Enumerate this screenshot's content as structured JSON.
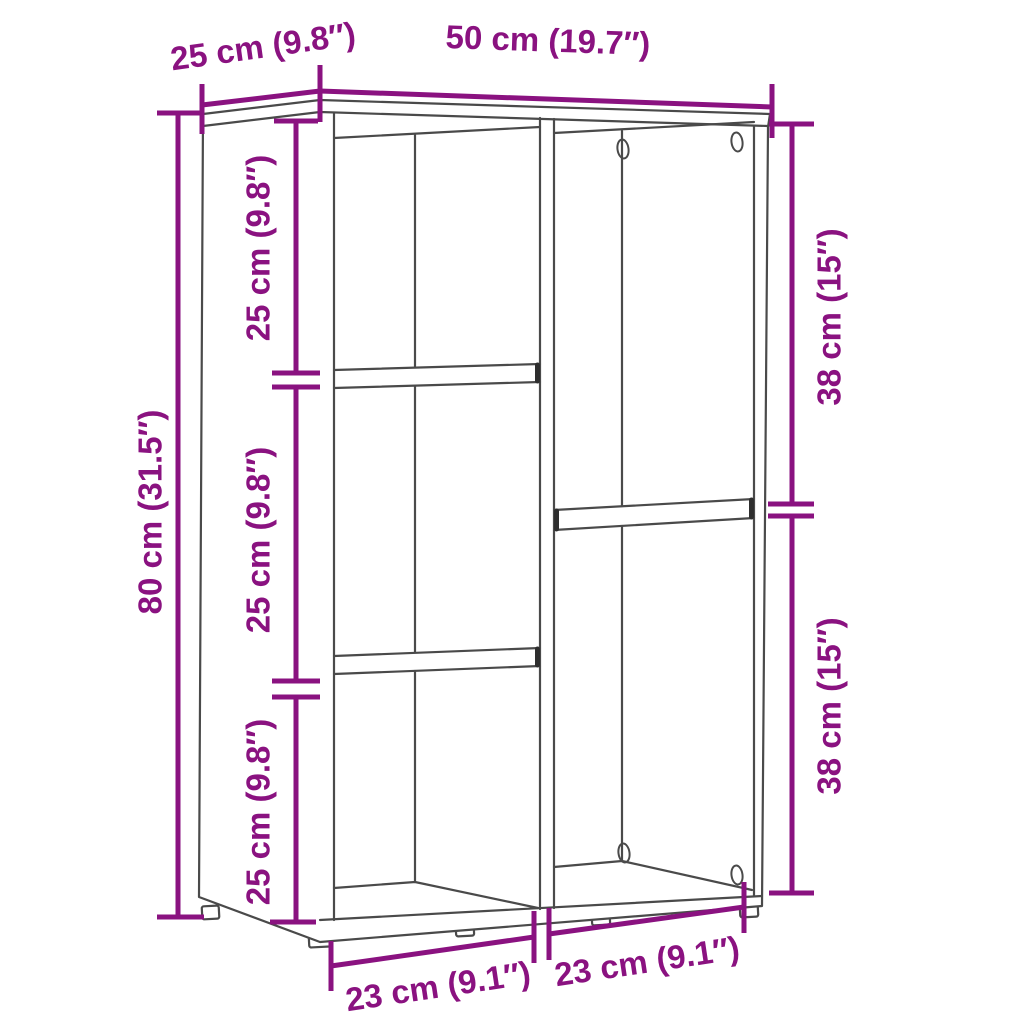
{
  "figure": {
    "kind": "furniture-dimension-diagram",
    "background": "#ffffff"
  },
  "colors": {
    "dimension": "#8A1280",
    "outline": "#4A4A4A",
    "shelf_cap": "#2E2E2E",
    "background": "#ffffff"
  },
  "labels": {
    "top_depth": "25 cm (9.8″)",
    "top_width": "50 cm (19.7″)",
    "height": "80 cm (31.5″)",
    "left_cells": [
      "25 cm (9.8″)",
      "25 cm (9.8″)",
      "25 cm (9.8″)"
    ],
    "right_cells": [
      "38 cm (15″)",
      "38 cm (15″)"
    ],
    "bottom_cells": [
      "23 cm (9.1″)",
      "23 cm (9.1″)"
    ]
  }
}
